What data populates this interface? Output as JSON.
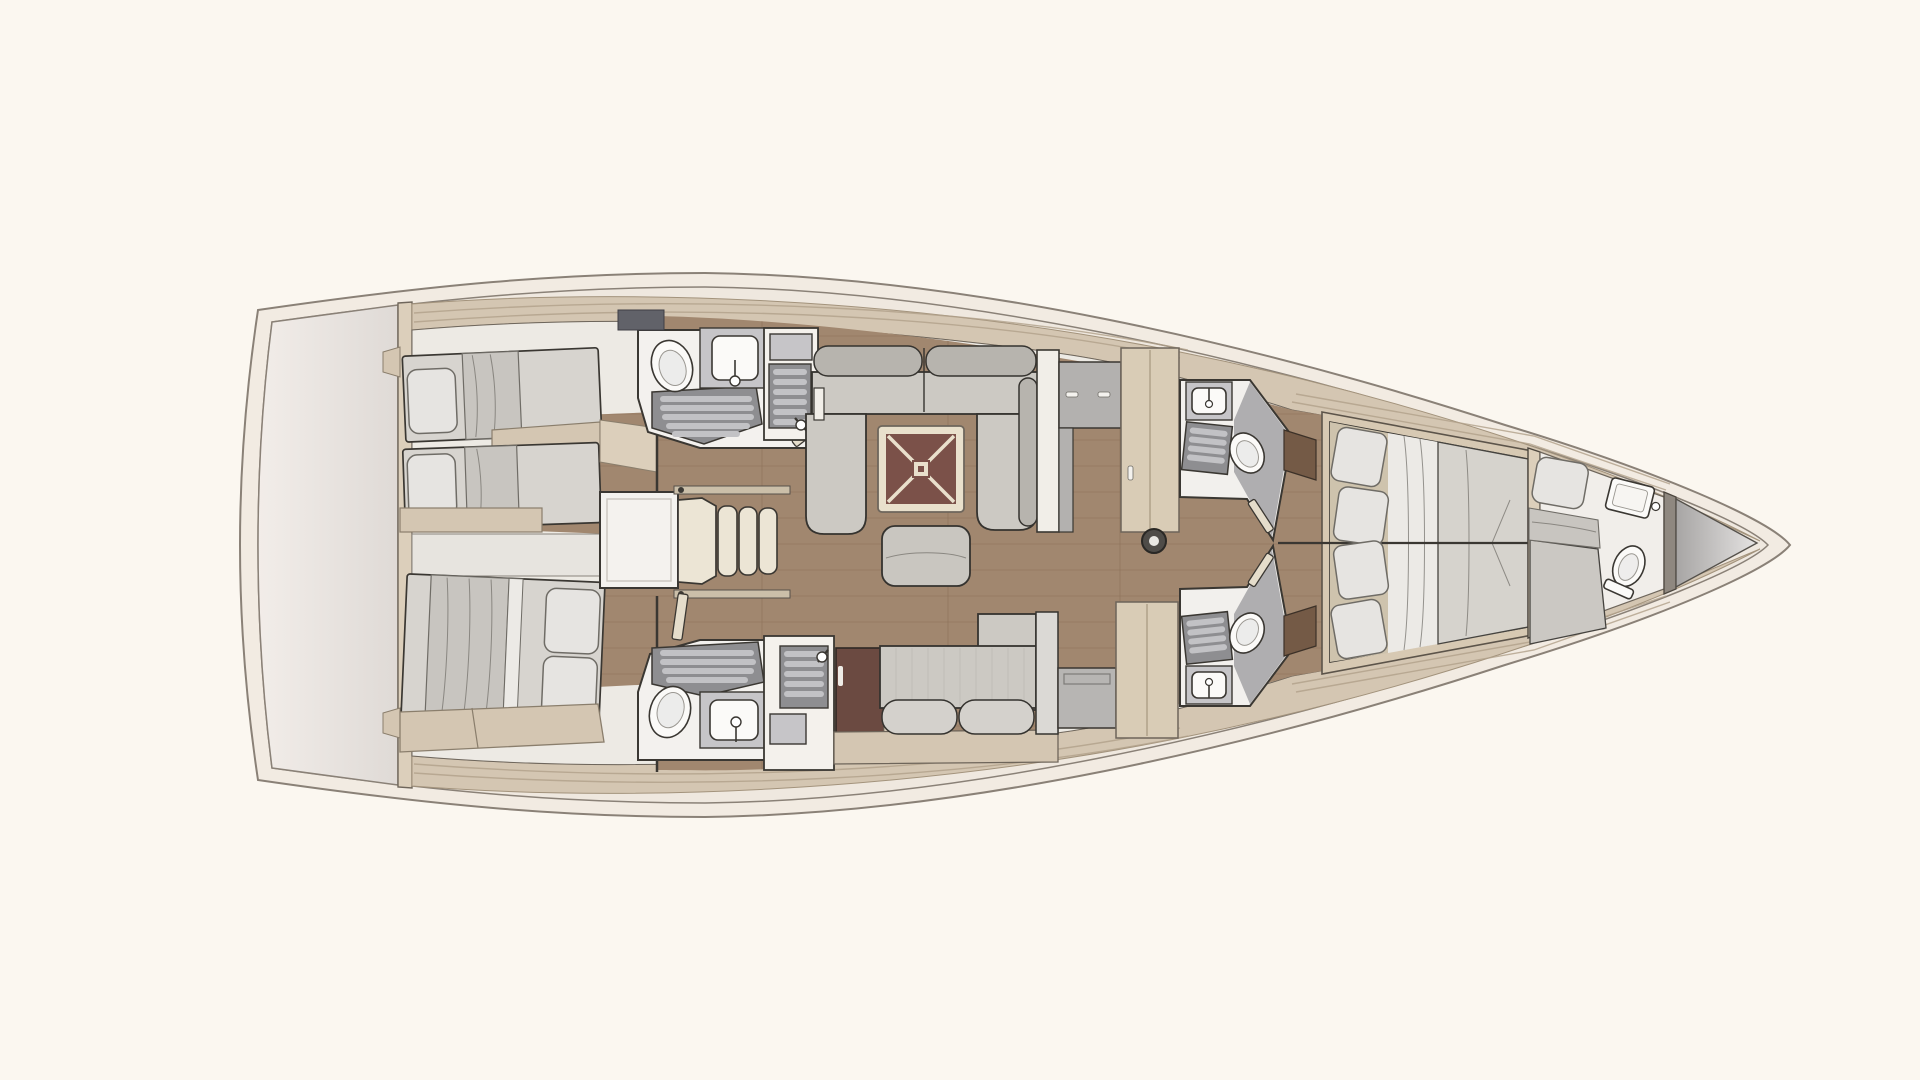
{
  "meta": {
    "title": "sailing-yacht-interior-floor-plan",
    "view": "top-down",
    "orientation": "bow-right, stern-left",
    "visible_text": "none"
  },
  "palette": {
    "bg": "#fbf7f0",
    "hullCream": "#f2ebe2",
    "hullLine": "#8a8177",
    "hullInner": "#efe8df",
    "deckTan": "#d4c6b2",
    "deckEdge": "#a3937c",
    "deckSeam": "#b0a089",
    "platformLight": "#f2ede9",
    "platformDark": "#dfdad6",
    "bulkheadBeige": "#dccfbb",
    "interiorBase": "#edeae4",
    "woodFloor": "#a1876f",
    "woodPlank": "#8c7158",
    "wallDark": "#3a3732",
    "sketch": "#6f6c66",
    "mattress": "#d7d4cf",
    "pillow": "#e6e4e1",
    "blanket": "#c8c5c0",
    "sheet": "#eceae6",
    "sofa": "#ccc9c3",
    "sofaBolster": "#b7b4ae",
    "sofaLight": "#d4d1cc",
    "sofaEdge": "#35332f",
    "tableFrame": "#e9e0cc",
    "tableTop": "#7b5149",
    "ottoman": "#c9c6c0",
    "maroonCabinet": "#6b4a41",
    "grayCabinet": "#b3b1af",
    "wardrobeBeige": "#d9ccb6",
    "fixtureWhite": "#fbfaf8",
    "counterGray": "#c6c5c8",
    "showerSlatDark": "#8e8e91",
    "showerSlatLight": "#c2c2c5",
    "stepsCream": "#ece5d5",
    "landingWhite": "#f4f2ee",
    "mastDark": "#4f4c48",
    "mastLight": "#e9e7e3",
    "forepeakDark": "#a7a5a4",
    "forepeakLight": "#e5e3e2",
    "doorLeaf": "#e5ddcb",
    "shelfDark": "#616269",
    "nightstandWood": "#745a46"
  },
  "plan": {
    "regions": [
      {
        "name": "stern-platform",
        "features": []
      },
      {
        "name": "aft-cabin-port",
        "features": [
          "single-berth",
          "single-berth",
          "pillows",
          "locker-shelf"
        ]
      },
      {
        "name": "aft-cabin-starboard",
        "features": [
          "double-berth",
          "two-pillows",
          "lockers"
        ]
      },
      {
        "name": "companionway",
        "features": [
          "landing",
          "three-steps"
        ]
      },
      {
        "name": "aft-head-port",
        "features": [
          "toilet",
          "sink",
          "shower"
        ]
      },
      {
        "name": "aft-head-starboard",
        "features": [
          "toilet",
          "sink",
          "shower"
        ]
      },
      {
        "name": "galley-port",
        "features": [
          "sink",
          "slatted-counter",
          "faucet"
        ]
      },
      {
        "name": "galley-starboard",
        "features": [
          "sink",
          "slatted-counter",
          "faucet",
          "maroon-locker"
        ]
      },
      {
        "name": "salon",
        "features": [
          "u-sofa-port",
          "folding-table",
          "ottoman",
          "settee-starboard",
          "mast-post",
          "pantry-cabinets",
          "wardrobe",
          "bench-locker"
        ]
      },
      {
        "name": "forward-head-port",
        "features": [
          "toilet",
          "sink",
          "shower",
          "door"
        ]
      },
      {
        "name": "forward-head-starboard",
        "features": [
          "toilet",
          "sink",
          "shower",
          "door"
        ]
      },
      {
        "name": "owner-cabin",
        "features": [
          "island-double-berth",
          "four-pillows",
          "nightstands",
          "side-shelves"
        ]
      },
      {
        "name": "bow-cabin",
        "features": [
          "single-berth",
          "pillow",
          "toilet",
          "sink"
        ]
      },
      {
        "name": "forepeak-locker",
        "features": []
      }
    ]
  }
}
